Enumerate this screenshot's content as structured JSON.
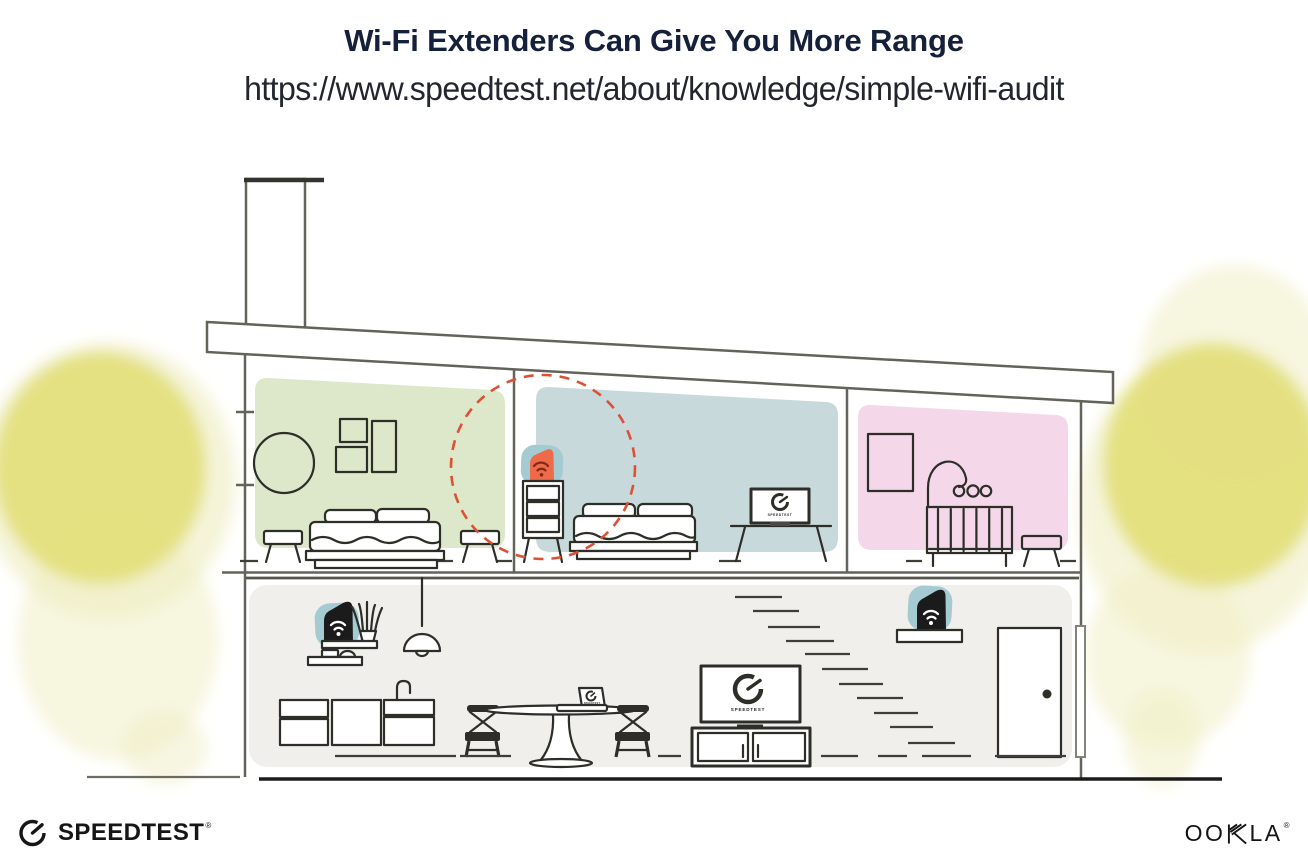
{
  "header": {
    "title": "Wi-Fi Extenders Can Give You More Range",
    "url": "https://www.speedtest.net/about/knowledge/simple-wifi-audit"
  },
  "illustration": {
    "screens": {
      "bedroom_tv_label": "SPEEDTEST",
      "living_room_tv_label": "SPEEDTEST",
      "laptop_label": "SPEEDTEST"
    },
    "colors": {
      "structure_line": "#63635b",
      "furniture_line": "#2e2e29",
      "room_green": "#dde8ca",
      "room_blue": "#c7d9da",
      "room_pink": "#f4d7e8",
      "floor_gray": "#f0efec",
      "extender_teal": "#a4cbd2",
      "extender_orange": "#ee6a49",
      "wifi_dark_red": "#7e2c17",
      "coverage_dash_red": "#dd5033",
      "foliage_yellow": "#e3e07b",
      "foliage_yellow_light": "#f0eec4",
      "device_black": "#1b1b1b",
      "ink": "#161616"
    }
  },
  "footer": {
    "speedtest_wordmark": "SPEEDTEST",
    "speedtest_registered": "®",
    "ookla_oo": "OO",
    "ookla_la": "LA",
    "ookla_registered": "®"
  }
}
